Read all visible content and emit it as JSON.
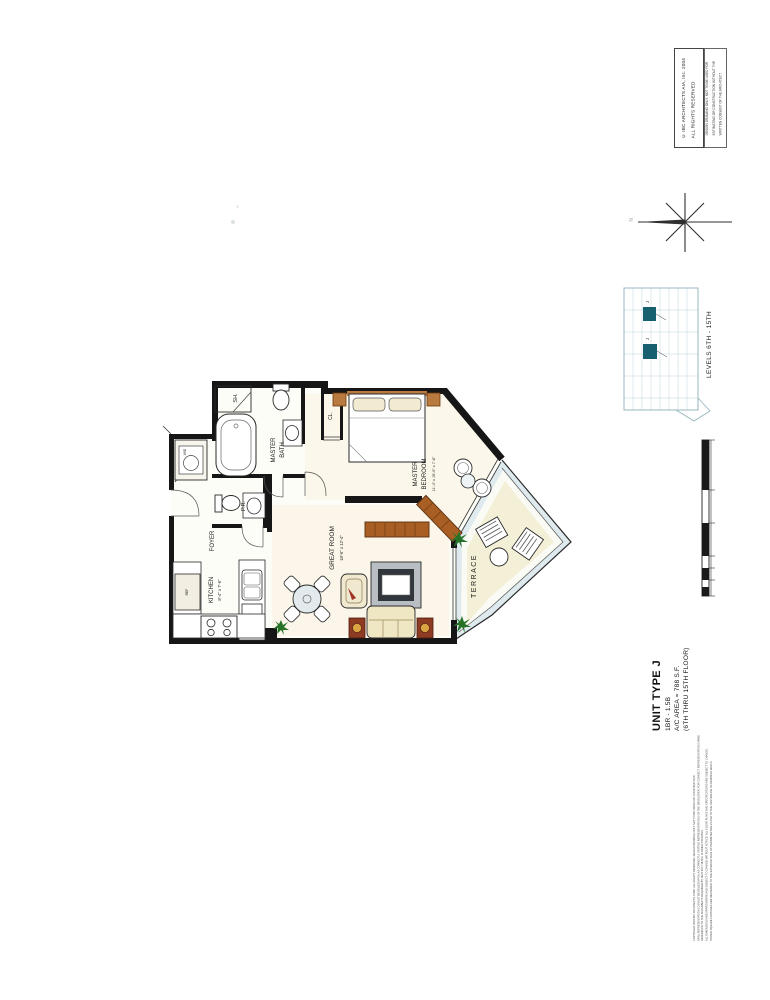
{
  "stamp": {
    "copyright_line1": "© IBC ARCHITECTS AIA, Inc. 2004",
    "copyright_line2": "ALL RIGHTS RESERVED",
    "notice_lines": [
      "DESIGN DRAWING ONLY. NOT TO BE USED FOR",
      "ESTIMATING OR CONSTRUCTION WITHOUT THE",
      "WRITTEN CONSENT OF THE ARCHITECT"
    ]
  },
  "compass": {
    "north_label": "N"
  },
  "keyplan": {
    "caption": "LEVELS 6TH - 15TH",
    "highlighted_unit": "J",
    "highlight_color": "#16606f"
  },
  "titleblock": {
    "unit_type": "UNIT TYPE J",
    "bed_bath": "1BR - 1.5B",
    "area": "A/C AREA = 788 S.F.",
    "floors": "(6TH THRU 15TH FLOOR)"
  },
  "rooms": {
    "shower": "SH.",
    "master_bath_l1": "MASTER",
    "master_bath_l2": "BATH",
    "closet": "CL.",
    "powder_room": "P.R.",
    "foyer": "FOYER",
    "kitchen": "KITCHEN",
    "kitchen_dims": "8'-4\" x 7'-6\"",
    "great_room": "GREAT ROOM",
    "great_room_dims": "18'-6\" x 12'-4\"",
    "bedroom_l1": "MASTER",
    "bedroom_l2": "BEDROOM",
    "bedroom_dims": "11'-4\" x 15'-0\" x 7'-6\"",
    "terrace": "TERRACE",
    "washer_dryer": "W/D",
    "fridge": "REF",
    "dishwasher": "DW"
  },
  "fine_print": {
    "lines": [
      "COPYRIGHT 2004 IBC ARCHITECTS CORP. ALL RIGHTS RESERVED. DESIGN DRAWING ONLY NOT TO BE USED FOR CONSTRUCTION.",
      "ORAL REPRESENTATIONS CANNOT BE RELIED UPON AS CORRECTLY STATING REPRESENTATIONS OF THE DEVELOPER. FOR CORRECT REPRESENTATIONS MAKE REFERENCE TO THE DOCUMENTS REQUIRED BY SECTION 718.503, FLORIDA STATUTES.",
      "ALL DIMENSIONS ARE APPROXIMATE AND SUBJECT TO CHANGE WITHOUT NOTICE. ALL FLOOR PLANS AND SPECIFICATIONS ARE SUBJECT TO CHANGE.",
      "STATED SQUARE FOOTAGES ARE MEASURED TO THE EXTERIOR FACE OF PERIMETER WALLS AND TO THE CENTERLINE OF DEMISING WALLS."
    ]
  },
  "colors": {
    "wall": "#161616",
    "wood": "#a95f23",
    "wood_dark": "#6d3a10",
    "plant_green": "#267328",
    "terrace_band": "#dfeaef",
    "floor_cream": "#f4efd7",
    "accent_table": "#8d3b22"
  }
}
